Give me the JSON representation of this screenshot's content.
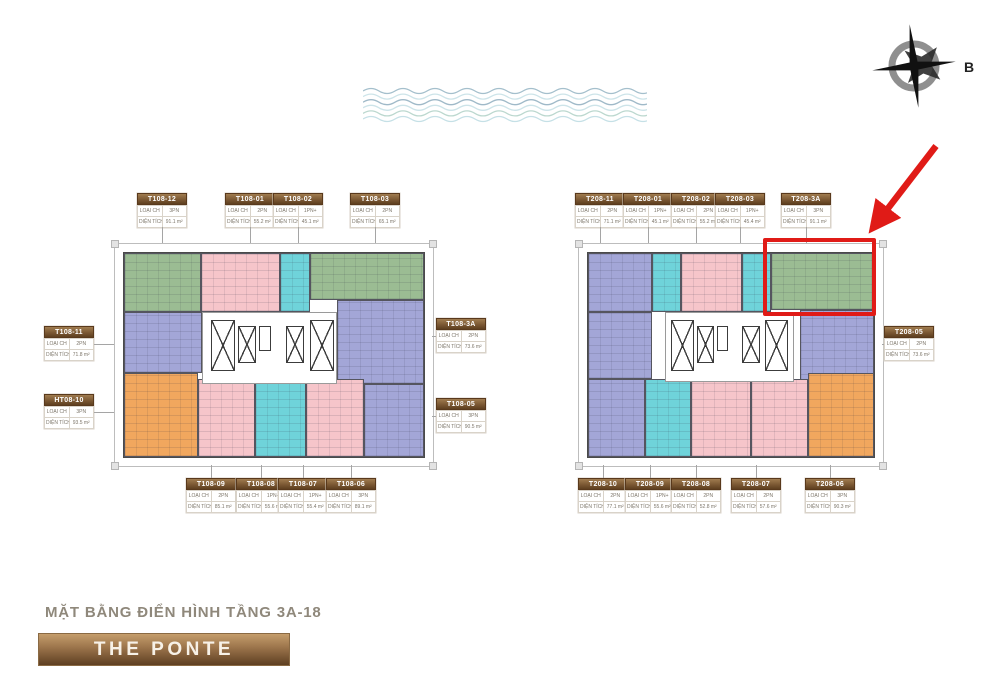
{
  "page": {
    "background": "#ffffff"
  },
  "compass": {
    "north_label": "B"
  },
  "footer": {
    "plan_title": "MẶT BẰNG ĐIỂN HÌNH TẦNG 3A-18",
    "brand": "THE PONTE"
  },
  "field_labels": {
    "type": "LOẠI CH",
    "area": "DIỆN TÍCH"
  },
  "annotation": {
    "color": "#e01b17",
    "highlighted_unit": "T208-3A"
  },
  "unit_colors": {
    "green": "#9bbc93",
    "pink": "#f6c5ca",
    "cyan": "#6fd3da",
    "purple": "#a3a6d7",
    "orange": "#f1a75e"
  },
  "plans": [
    {
      "id": "T108",
      "frame": {
        "x": 114,
        "y": 243,
        "w": 318,
        "h": 222
      },
      "units": [
        {
          "color": "green",
          "x": 0,
          "y": 0,
          "w": 25.5,
          "h": 29
        },
        {
          "color": "pink",
          "x": 25.5,
          "y": 0,
          "w": 26.5,
          "h": 29
        },
        {
          "color": "cyan",
          "x": 52,
          "y": 0,
          "w": 10,
          "h": 29
        },
        {
          "color": "green",
          "x": 62,
          "y": 0,
          "w": 38,
          "h": 23
        },
        {
          "color": "purple",
          "x": 0,
          "y": 29,
          "w": 26,
          "h": 30
        },
        {
          "color": "purple",
          "x": 71,
          "y": 23,
          "w": 29,
          "h": 41
        },
        {
          "color": "orange",
          "x": 0,
          "y": 59,
          "w": 24.5,
          "h": 41
        },
        {
          "color": "pink",
          "x": 24.5,
          "y": 62,
          "w": 19,
          "h": 38
        },
        {
          "color": "cyan",
          "x": 43.5,
          "y": 62,
          "w": 17,
          "h": 38
        },
        {
          "color": "pink",
          "x": 60.5,
          "y": 62,
          "w": 19.5,
          "h": 38
        },
        {
          "color": "purple",
          "x": 80,
          "y": 64,
          "w": 20,
          "h": 36
        }
      ],
      "core": {
        "x": 26,
        "y": 29,
        "w": 45,
        "h": 35
      },
      "labels": [
        {
          "code": "T108-12",
          "type": "3PN",
          "area": "91.1 m²",
          "side": "top",
          "x": 137,
          "y": 193
        },
        {
          "code": "T108-01",
          "type": "2PN",
          "area": "55.2 m²",
          "side": "top",
          "x": 225,
          "y": 193
        },
        {
          "code": "T108-02",
          "type": "1PN+",
          "area": "45.1 m²",
          "side": "top",
          "x": 273,
          "y": 193
        },
        {
          "code": "T108-03",
          "type": "2PN",
          "area": "65.1 m²",
          "side": "top",
          "x": 350,
          "y": 193
        },
        {
          "code": "T108-11",
          "type": "2PN",
          "area": "71.8 m²",
          "side": "left",
          "x": 44,
          "y": 326
        },
        {
          "code": "HT08-10",
          "type": "3PN",
          "area": "93.5 m²",
          "side": "left",
          "x": 44,
          "y": 394
        },
        {
          "code": "T108-3A",
          "type": "2PN",
          "area": "73.6 m²",
          "side": "right",
          "x": 436,
          "y": 318
        },
        {
          "code": "T108-05",
          "type": "3PN",
          "area": "90.5 m²",
          "side": "right",
          "x": 436,
          "y": 398
        },
        {
          "code": "T108-09",
          "type": "2PN",
          "area": "85.1 m²",
          "side": "bottom",
          "x": 186,
          "y": 478
        },
        {
          "code": "T108-08",
          "type": "1PN+",
          "area": "55.6 m²",
          "side": "bottom",
          "x": 236,
          "y": 478
        },
        {
          "code": "T108-07",
          "type": "1PN+",
          "area": "55.4 m²",
          "side": "bottom",
          "x": 278,
          "y": 478
        },
        {
          "code": "T108-06",
          "type": "3PN",
          "area": "89.1 m²",
          "side": "bottom",
          "x": 326,
          "y": 478
        }
      ]
    },
    {
      "id": "T208",
      "frame": {
        "x": 578,
        "y": 243,
        "w": 304,
        "h": 222
      },
      "units": [
        {
          "color": "purple",
          "x": 0,
          "y": 0,
          "w": 22.5,
          "h": 29
        },
        {
          "color": "cyan",
          "x": 22.5,
          "y": 0,
          "w": 10,
          "h": 29
        },
        {
          "color": "pink",
          "x": 32.5,
          "y": 0,
          "w": 21.5,
          "h": 29
        },
        {
          "color": "cyan",
          "x": 54,
          "y": 0,
          "w": 10,
          "h": 29
        },
        {
          "color": "green",
          "x": 64,
          "y": 0,
          "w": 36,
          "h": 28
        },
        {
          "color": "purple",
          "x": 0,
          "y": 29,
          "w": 22.5,
          "h": 33
        },
        {
          "color": "purple",
          "x": 74,
          "y": 28,
          "w": 26,
          "h": 36
        },
        {
          "color": "purple",
          "x": 0,
          "y": 62,
          "w": 20,
          "h": 38
        },
        {
          "color": "cyan",
          "x": 20,
          "y": 62,
          "w": 16,
          "h": 38
        },
        {
          "color": "pink",
          "x": 36,
          "y": 62,
          "w": 21,
          "h": 38
        },
        {
          "color": "pink",
          "x": 57,
          "y": 62,
          "w": 20,
          "h": 38
        },
        {
          "color": "orange",
          "x": 77,
          "y": 59,
          "w": 23,
          "h": 41
        }
      ],
      "core": {
        "x": 27,
        "y": 29,
        "w": 45,
        "h": 34
      },
      "labels": [
        {
          "code": "T208-11",
          "type": "2PN",
          "area": "71.1 m²",
          "side": "top",
          "x": 575,
          "y": 193
        },
        {
          "code": "T208-01",
          "type": "1PN+",
          "area": "45.1 m²",
          "side": "top",
          "x": 623,
          "y": 193
        },
        {
          "code": "T208-02",
          "type": "2PN",
          "area": "55.2 m²",
          "side": "top",
          "x": 671,
          "y": 193
        },
        {
          "code": "T208-03",
          "type": "1PN+",
          "area": "45.4 m²",
          "side": "top",
          "x": 715,
          "y": 193
        },
        {
          "code": "T208-3A",
          "type": "3PN",
          "area": "91.1 m²",
          "side": "top",
          "x": 781,
          "y": 193
        },
        {
          "code": "T208-05",
          "type": "2PN",
          "area": "73.6 m²",
          "side": "right",
          "x": 884,
          "y": 326
        },
        {
          "code": "T208-10",
          "type": "2PN",
          "area": "77.1 m²",
          "side": "bottom",
          "x": 578,
          "y": 478
        },
        {
          "code": "T208-09",
          "type": "1PN+",
          "area": "55.6 m²",
          "side": "bottom",
          "x": 625,
          "y": 478
        },
        {
          "code": "T208-08",
          "type": "2PN",
          "area": "52.8 m²",
          "side": "bottom",
          "x": 671,
          "y": 478
        },
        {
          "code": "T208-07",
          "type": "2PN",
          "area": "57.6 m²",
          "side": "bottom",
          "x": 731,
          "y": 478
        },
        {
          "code": "T208-06",
          "type": "3PN",
          "area": "90.3 m²",
          "side": "bottom",
          "x": 805,
          "y": 478
        }
      ]
    }
  ]
}
